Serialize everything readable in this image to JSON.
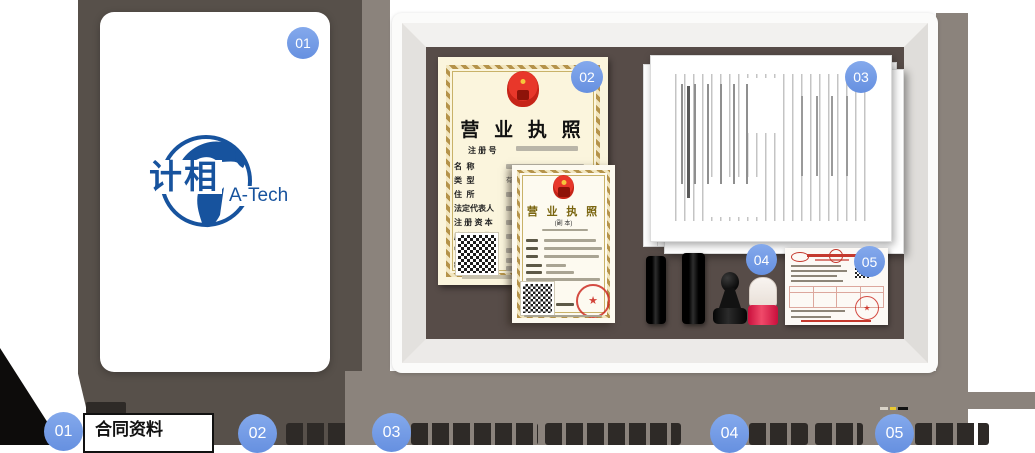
{
  "brand": {
    "logo_cn": "计相",
    "logo_en": "A-Tech"
  },
  "colors": {
    "badge_blue": "#6F98E3",
    "frame_interior_brown": "#574C48",
    "background_taupe": "#57504A",
    "shadow_gray": "#8B837C",
    "license_paper": "#FBF5DD",
    "seal_red": "#C4392E",
    "stamp_red": "#E1184A",
    "logo_blue": "#17539E"
  },
  "badges": {
    "b1": "01",
    "b2": "02",
    "b3": "03",
    "b4": "04",
    "b5": "05"
  },
  "license_main": {
    "title": "营 业 执 照",
    "reg_label": "注 册 号",
    "type_value": "有限责任公司(自然人投资或控股)",
    "fields": [
      "名  称",
      "类  型",
      "住  所",
      "法定代表人",
      "注 册 资 本",
      "成 立 日 期",
      "营 业 期 限",
      "经 营 范 围"
    ]
  },
  "license_copy": {
    "title": "营 业 执 照",
    "subtitle": "(副 本)"
  },
  "bottom_steps": [
    {
      "num": "01",
      "label": "合同资料"
    },
    {
      "num": "02",
      "label": ""
    },
    {
      "num": "03",
      "label": ""
    },
    {
      "num": "04",
      "label": ""
    },
    {
      "num": "05",
      "label": ""
    }
  ]
}
